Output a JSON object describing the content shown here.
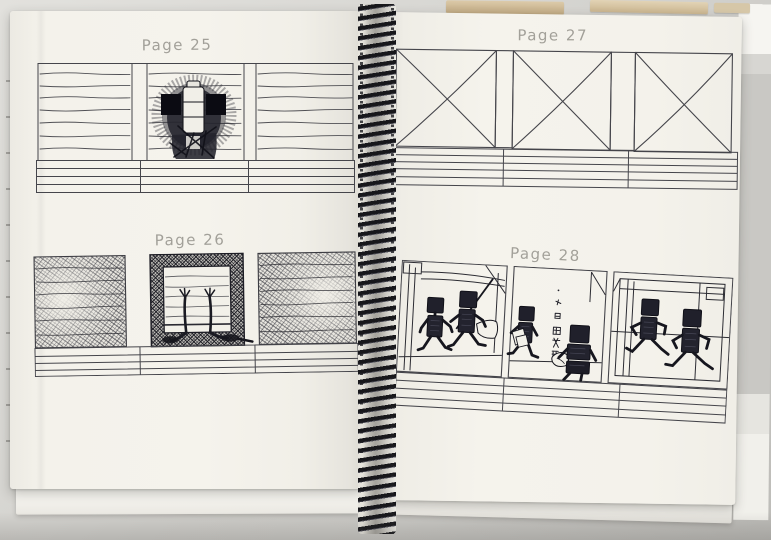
{
  "photo": {
    "subject": "Open spread of a spiral-bound storyboard sketchbook photographed on a grey surface",
    "paper_color": "#f4f2eb",
    "backdrop_color": "#cfcec9",
    "ink_color": "#20202a",
    "pencil_color": "#97958e"
  },
  "left_page": {
    "sections": [
      {
        "title": "Page 25",
        "panels": [
          "slatted wall of horizontal lines",
          "dark scribbled creature with pale segmented spine behind slats",
          "slatted wall of horizontal lines"
        ]
      },
      {
        "title": "Page 26",
        "panels": [
          "dense curved scribble hatching",
          "dark hatched doorway with two arms reaching up",
          "dense curved scribble hatching"
        ]
      }
    ]
  },
  "right_page": {
    "sections": [
      {
        "title": "Page 27",
        "panels": [
          "empty frame crossed out with X",
          "empty frame crossed out with X",
          "empty frame crossed out with X"
        ]
      },
      {
        "title": "Page 28",
        "panels": [
          "two box-headed robots walking through corridor",
          "robot carrying papers, wall marks, seated robot",
          "two box-headed robots running through doorway"
        ]
      }
    ]
  }
}
